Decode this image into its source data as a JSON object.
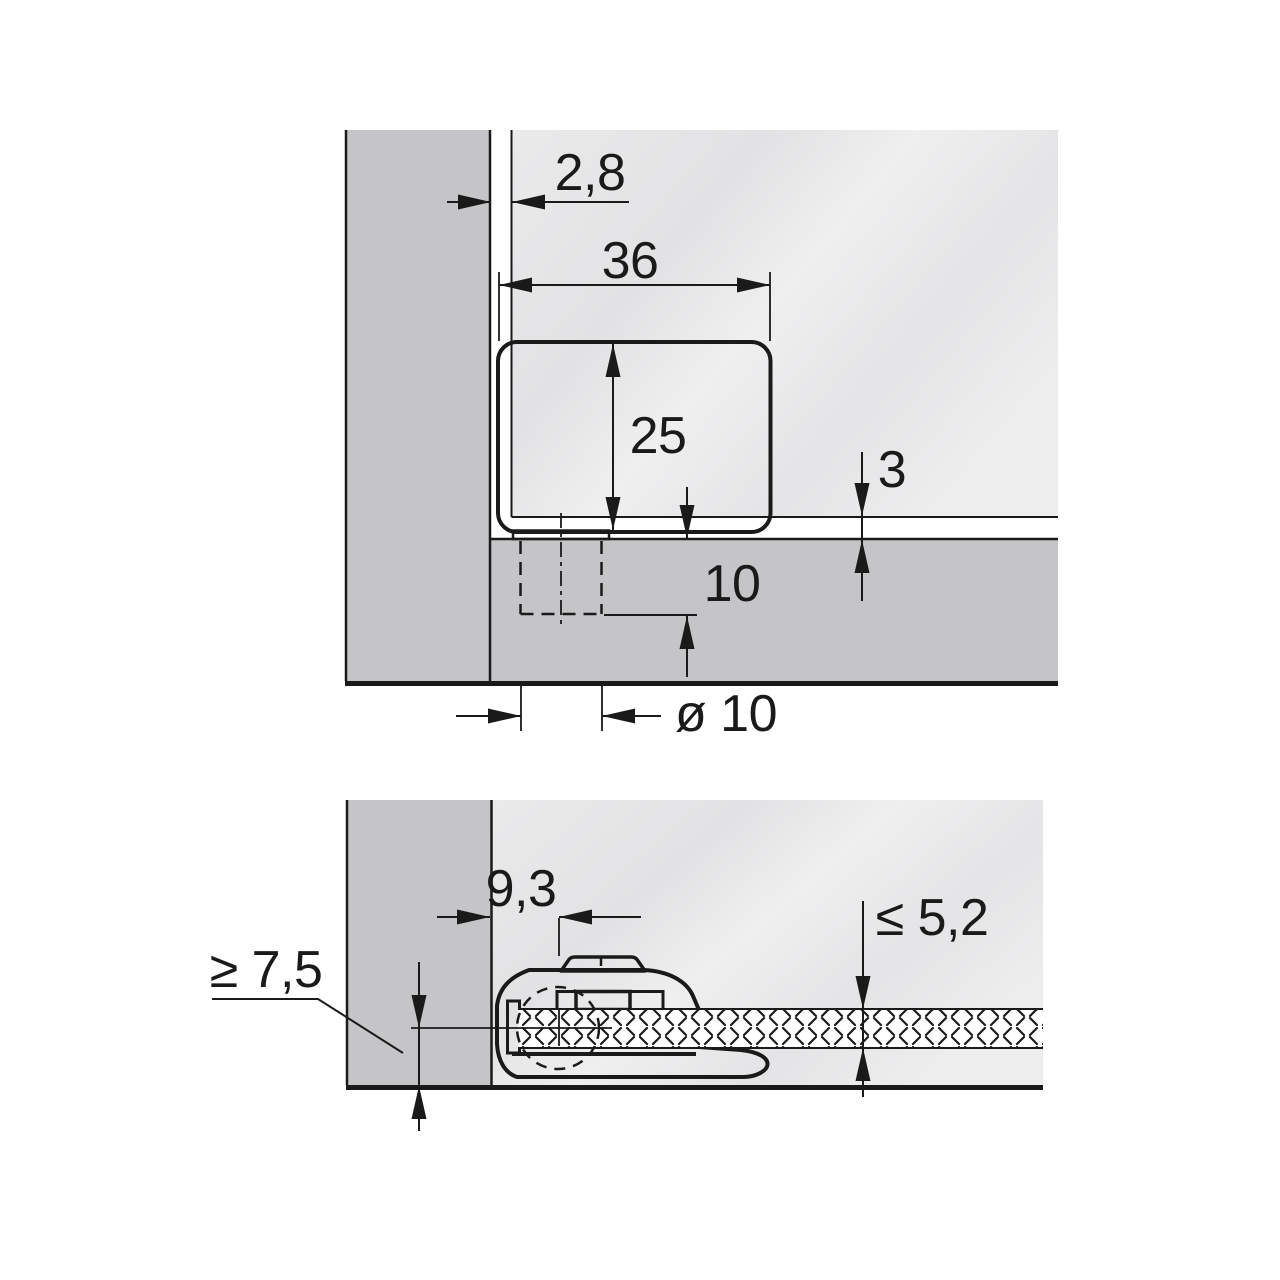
{
  "drawing": {
    "type": "hinge-mounting-dimension-drawing",
    "views": {
      "top": {
        "dims": {
          "panel_to_door_gap": "2,8",
          "hinge_width": "36",
          "hinge_height": "25",
          "bottom_reveal": "3",
          "hole_depth": "10",
          "hole_diameter": "ø 10"
        }
      },
      "bottom": {
        "dims": {
          "hole_center_offset": "9,3",
          "glass_thickness_max": "≤ 5,2",
          "edge_distance_min": "≥ 7,5"
        }
      }
    },
    "colors": {
      "line": "#1a1a1a",
      "panel": "#c5c5c7",
      "glass_face": "#e8e8ea",
      "hinge": "#a8a8aa",
      "plate": "#8f8f92",
      "white": "#ffffff",
      "background": "#ffffff"
    }
  }
}
